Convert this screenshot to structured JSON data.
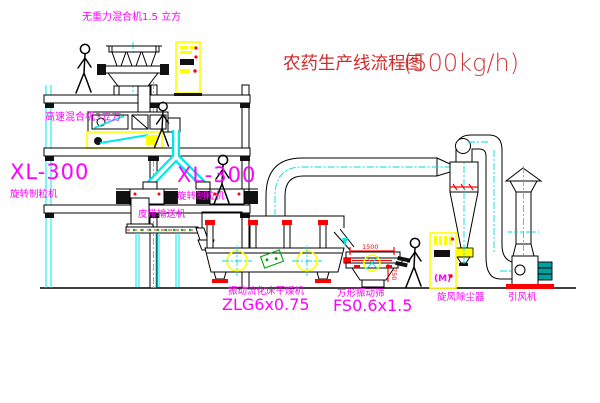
{
  "title": {
    "name": "农药生产线流程图",
    "capacity": "(500kg/h)"
  },
  "labels": {
    "top_mixer": "无重力混合机1.5 立方",
    "mid_mixer": "高速混合机3立方",
    "granulator_left_model": "XL-300",
    "granulator_left_name": "旋转制粒机",
    "granulator_right_model": "XL-300",
    "granulator_right_name": "旋转制粒机",
    "belt_conveyor": "皮带输送机",
    "dryer_name": "振动流化床干燥机",
    "dryer_model": "ZLG6x0.75",
    "sieve_name": "方形振动筛",
    "sieve_model": "FS0.6x1.5",
    "cyclone": "旋风除尘器",
    "fan": "引风机"
  },
  "dimensions": {
    "sieve_width": "1500",
    "sieve_height": "750"
  },
  "cabinet": {
    "marking": "(M)"
  },
  "colors": {
    "label_magenta": "#ff00ff",
    "title_red": "#cc2b2b",
    "line_black": "#000000",
    "centerline_cyan": "#00dede",
    "chute_cyan": "#00e8e8",
    "cabinet_yellow": "#ffff00",
    "accent_red": "#ff0000",
    "motor_teal": "#00a0a0",
    "plate_green": "#00a000",
    "background": "#ffffff"
  }
}
